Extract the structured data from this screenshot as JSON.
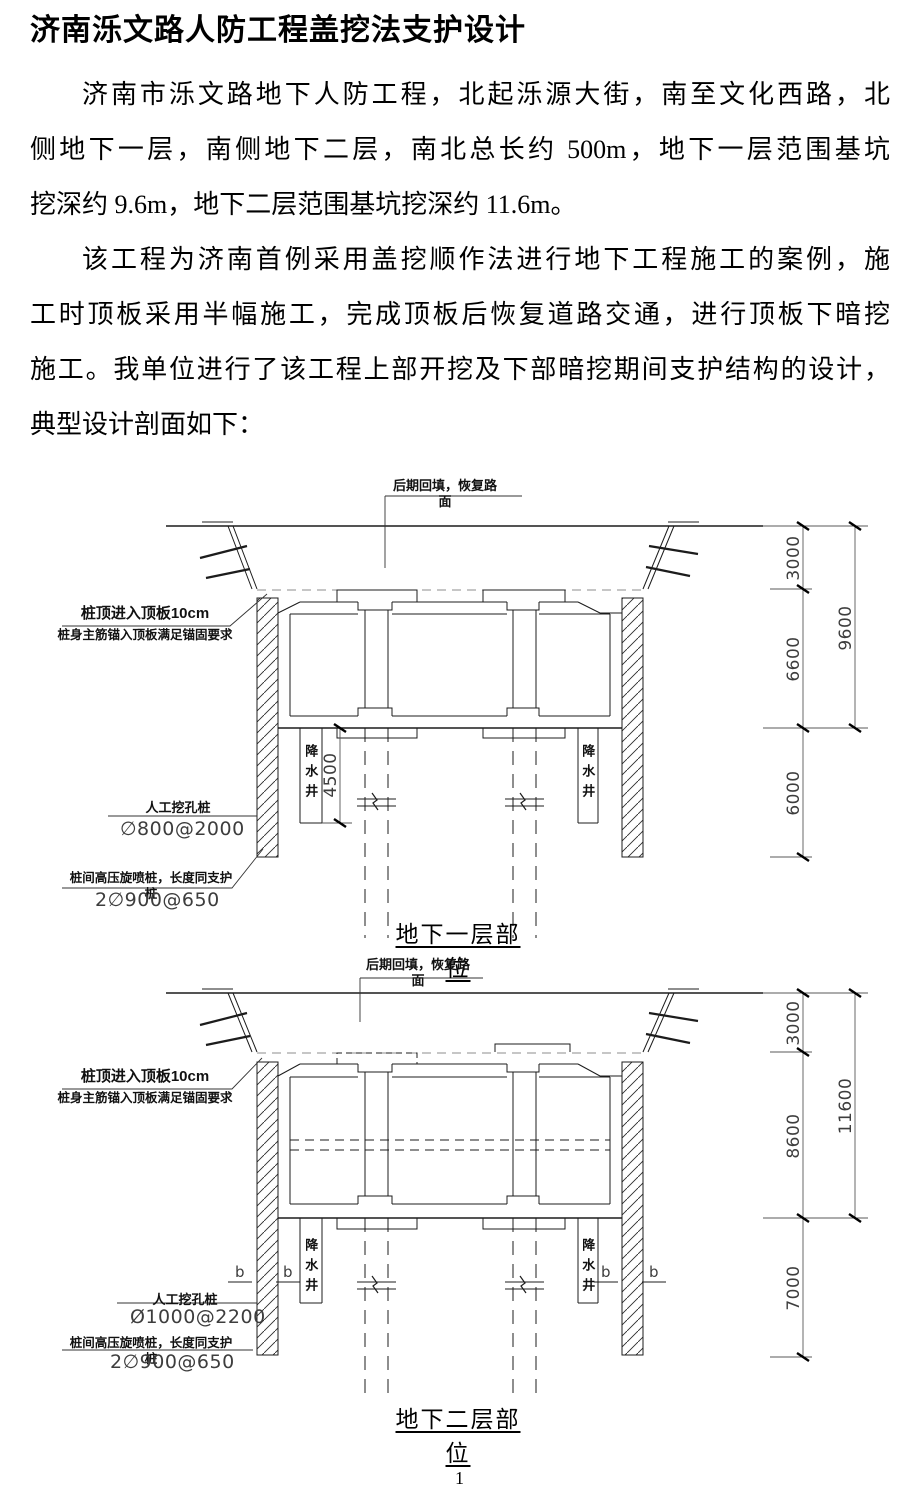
{
  "document": {
    "title": "济南泺文路人防工程盖挖法支护设计",
    "page_number": "1",
    "paragraphs": [
      {
        "lines": [
          "济南市泺文路地下人防工程，北起泺源大街，南至文化西路，北",
          "侧地下一层，南侧地下二层，南北总长约 500m，地下一层范围基坑",
          "挖深约 9.6m，地下二层范围基坑挖深约 11.6m。"
        ]
      },
      {
        "lines": [
          "该工程为济南首例采用盖挖顺作法进行地下工程施工的案例，施",
          "工时顶板采用半幅施工，完成顶板后恢复道路交通，进行顶板下暗挖",
          "施工。我单位进行了该工程上部开挖及下部暗挖期间支护结构的设计，",
          "典型设计剖面如下："
        ]
      }
    ]
  },
  "diagram1": {
    "caption": "地下一层部位",
    "backfill_label": "后期回填，恢复路面",
    "pile_top_note_line1": "桩顶进入顶板10cm",
    "pile_top_note_line2": "桩身主筋锚入顶板满足锚固要求",
    "hand_dug_pile_label": "人工挖孔桩",
    "hand_dug_pile_spec": "∅800@2000",
    "jet_grout_pile_label": "桩间高压旋喷桩，长度同支护桩",
    "jet_grout_pile_spec": "2∅900@650",
    "dewatering_well_left": "降水井",
    "dewatering_well_right": "降水井",
    "well_depth_dim": "4500",
    "dim_fill": "3000",
    "dim_structure": "6600",
    "dim_below": "6000",
    "dim_total": "9600"
  },
  "diagram2": {
    "caption": "地下二层部位",
    "backfill_label": "后期回填，恢复路面",
    "pile_top_note_line1": "桩顶进入顶板10cm",
    "pile_top_note_line2": "桩身主筋锚入顶板满足锚固要求",
    "hand_dug_pile_label": "人工挖孔桩",
    "hand_dug_pile_spec": "Ø1000@2200",
    "jet_grout_pile_label": "桩间高压旋喷桩，长度同支护桩",
    "jet_grout_pile_spec": "2∅900@650",
    "dewatering_well_left": "降水井",
    "dewatering_well_right": "降水井",
    "section_markers": [
      "b",
      "b",
      "b",
      "b"
    ],
    "dim_fill": "3000",
    "dim_structure": "8600",
    "dim_below": "7000",
    "dim_total": "11600"
  }
}
